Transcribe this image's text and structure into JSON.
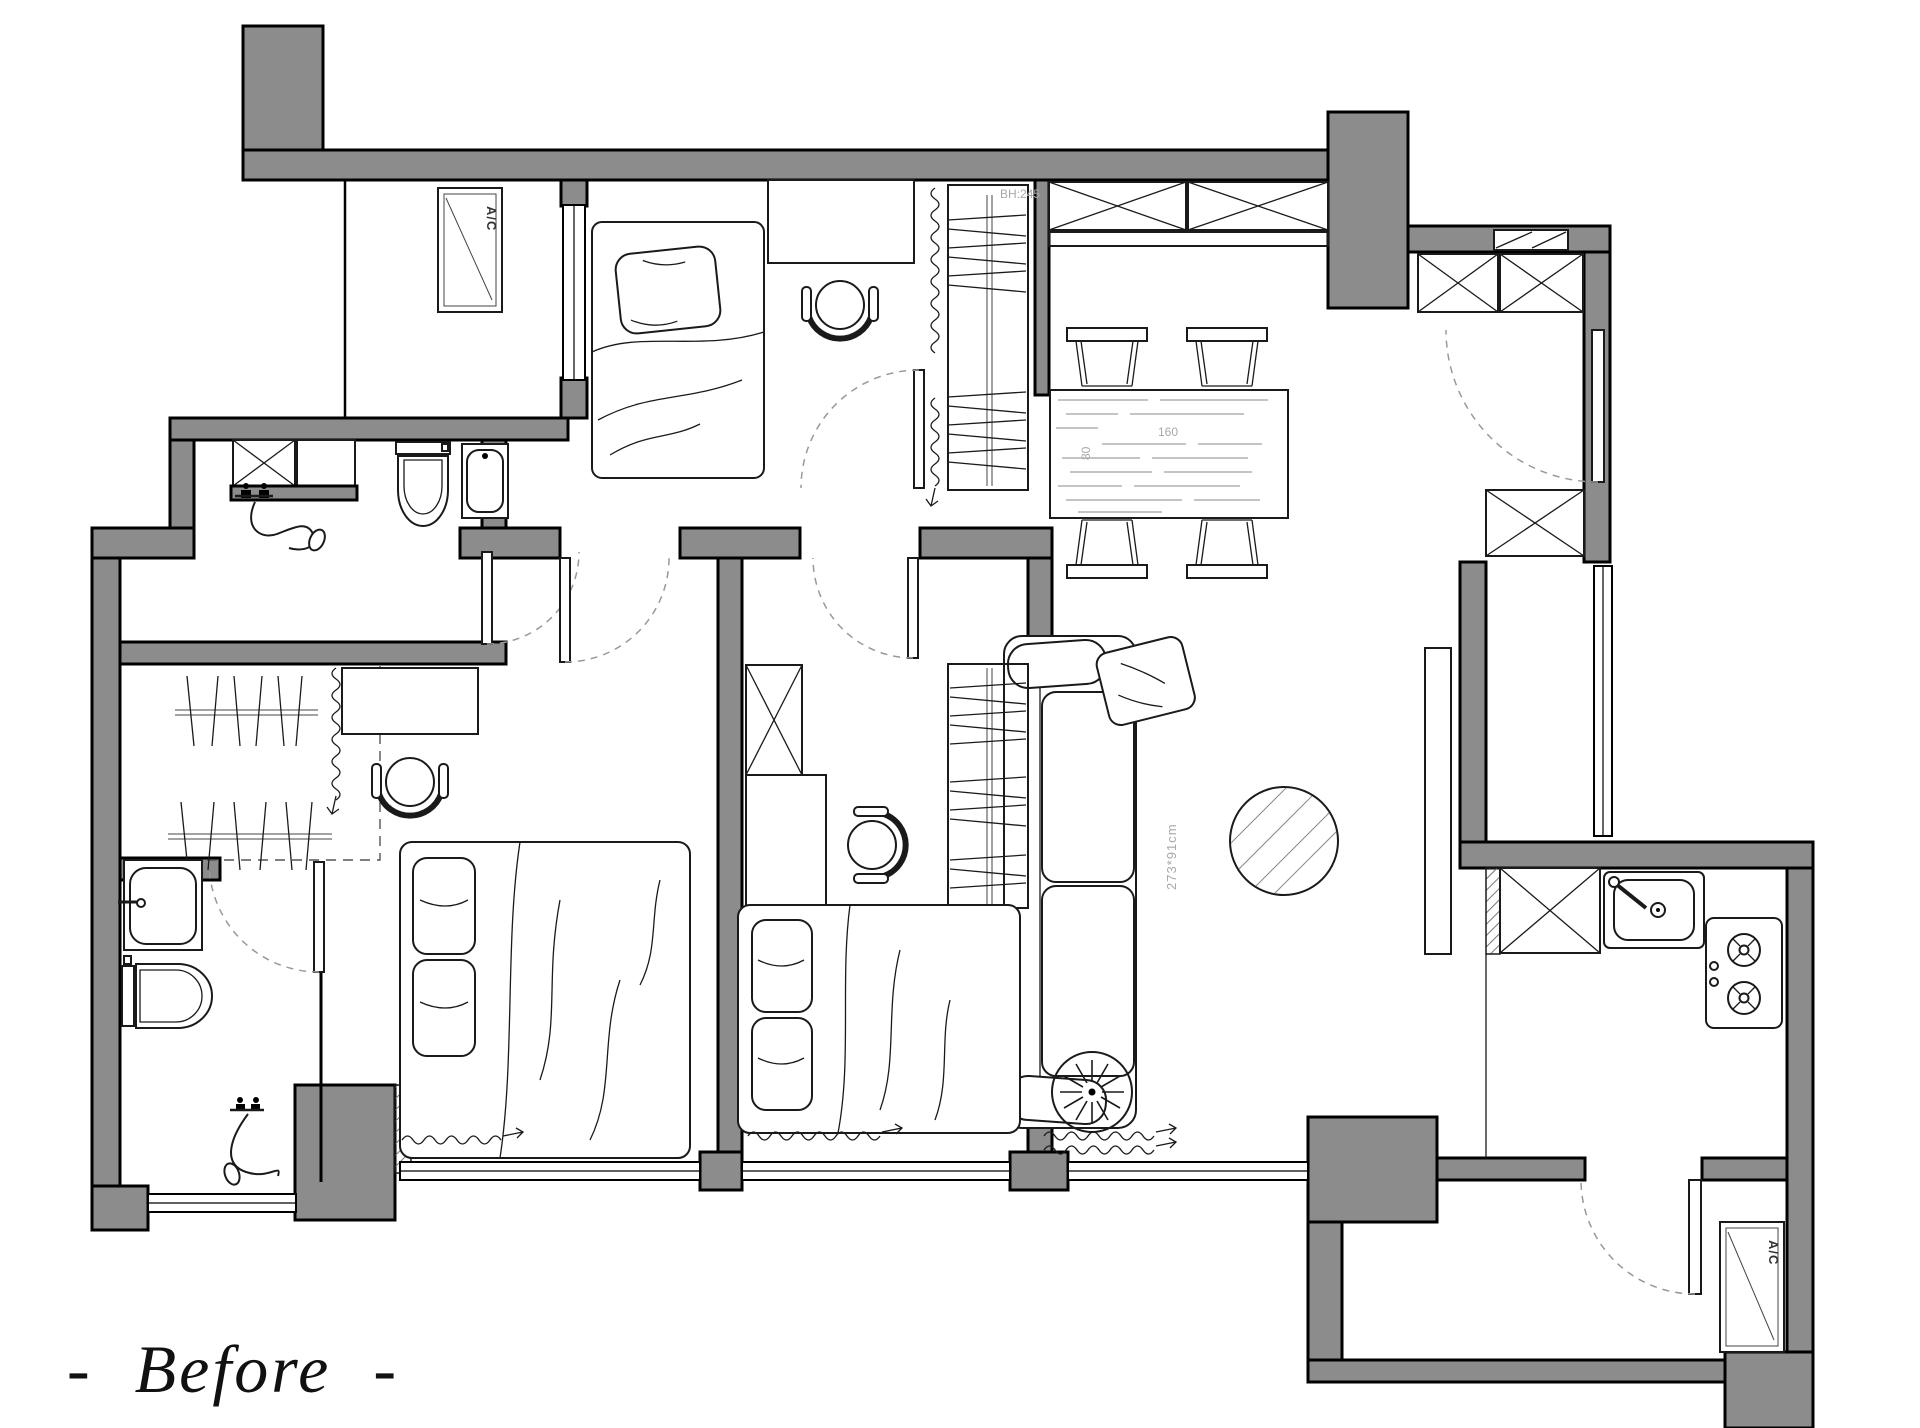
{
  "caption": "-  Before  -",
  "labels": {
    "ac_top": "A/C",
    "ac_bottom": "A/C",
    "beam_height": "BH:245",
    "table_length": "160",
    "table_width": "80",
    "sofa_size": "273*91cm"
  },
  "colors": {
    "wall_fill": "#8c8c8c",
    "line": "#000000",
    "dim_text": "#a8a8a8",
    "caption": "#111111",
    "background": "#ffffff"
  }
}
